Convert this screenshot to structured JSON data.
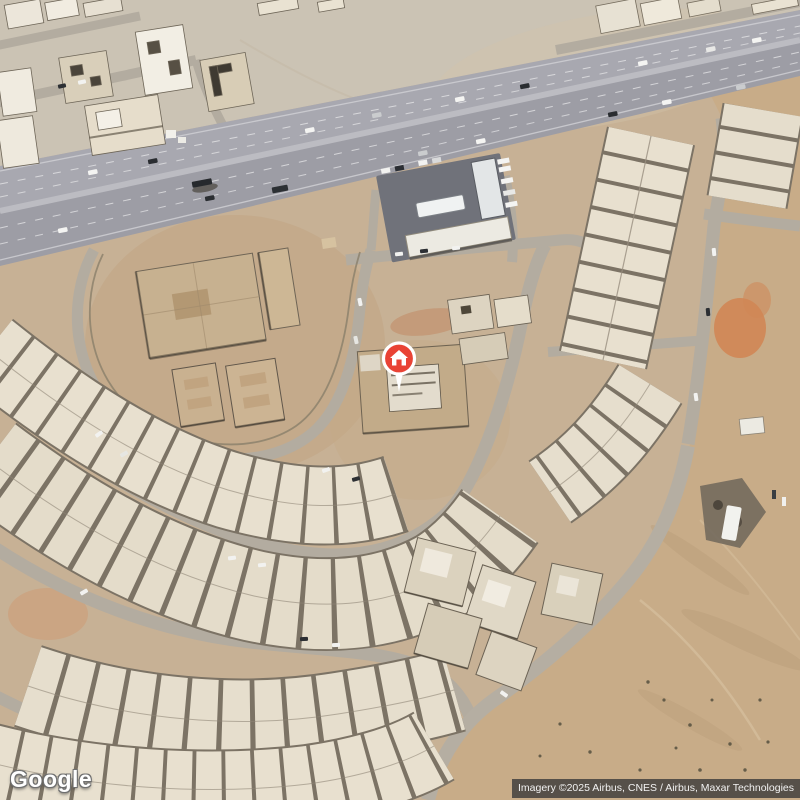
{
  "map": {
    "logo_text": "Google",
    "attribution": "Imagery ©2025 Airbus, CNES / Airbus, Maxar Technologies",
    "marker": {
      "label": "home",
      "icon": "home-icon",
      "color": "#E94335",
      "ring_color": "#ffffff",
      "x": 399,
      "y": 358
    },
    "colors": {
      "sand_base": "#c7b195",
      "sand_north": "#cbc3b4",
      "desert_east": "#c8ac88",
      "orange_patch": "#d08655",
      "road": "#b3aca0",
      "highway_asphalt": "#a3a3ab",
      "highway_median": "#bcbcc2",
      "building_light": "#e8e0cf",
      "building_shadow": "#7c7365",
      "school_roof": "#c7b190",
      "attribution_bg": "rgba(58,58,58,0.8)"
    }
  }
}
